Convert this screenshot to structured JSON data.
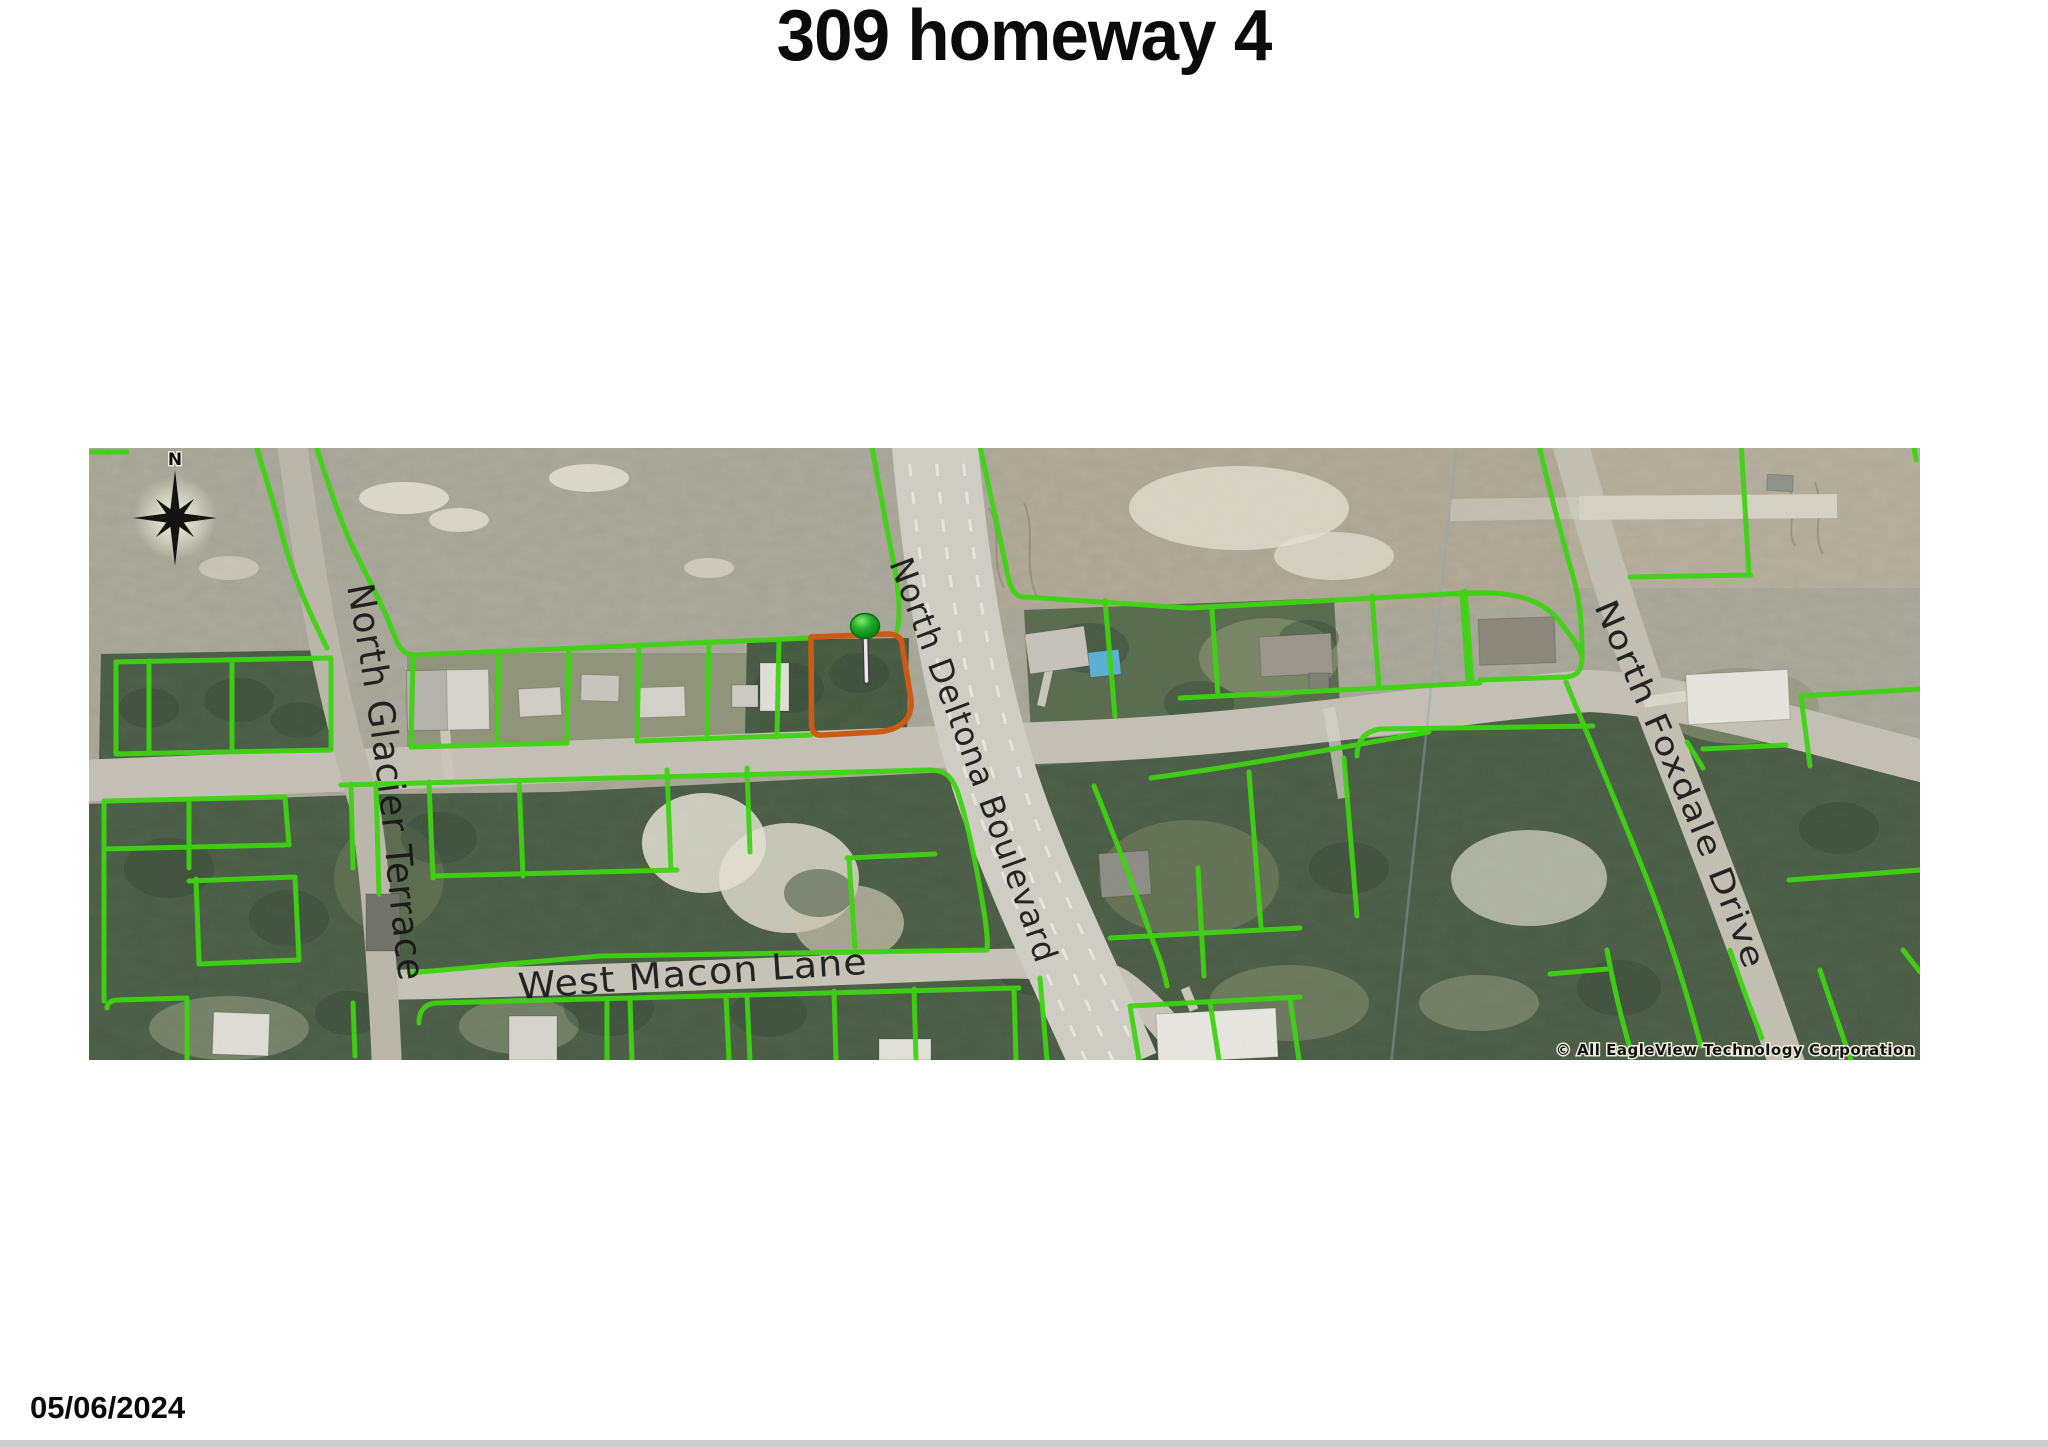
{
  "title": "309 homeway 4",
  "date": "05/06/2024",
  "map": {
    "compass_label": "N",
    "streets": {
      "glacier": "North Glacier Terrace",
      "deltona": "North Deltona Boulevard",
      "macon": "West Macon Lane",
      "foxdale": "North Foxdale Drive"
    },
    "copyright": "© All EagleView Technology Corporation",
    "marker": "subject-property-pin"
  },
  "colors": {
    "page_bg": "#ffffff",
    "bottom_bar": "#cdcdcd",
    "parcel_line": "#3ed312",
    "subject_outline": "#cd5a12",
    "pin_green": "#1fae2a",
    "pin_highlight": "#8ae968",
    "road_minor": "#c6c2b7",
    "road_major": "#d3d0c7",
    "lane_marking": "#f2f0e9",
    "scrub": "#a3a193",
    "scrub_tan": "#b0a896",
    "trees": "#44543f",
    "trees_dark": "#2e4130",
    "sand": "#e9e5d7",
    "pool": "#58b1d9",
    "label_text": "#161616",
    "copyright_halo": "#eeecd8"
  }
}
